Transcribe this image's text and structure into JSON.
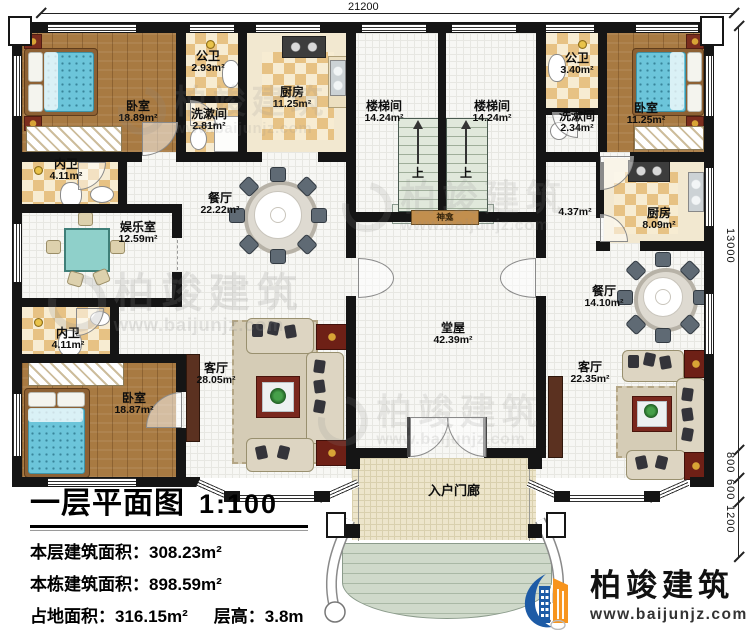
{
  "dimensions": {
    "top_width": "21200",
    "right_height": "13000",
    "right_seg_800": "800",
    "right_seg_600": "600",
    "right_seg_1200": "1200"
  },
  "rooms": {
    "bedroom_tl": {
      "name": "卧室",
      "area": "18.89m²"
    },
    "bath_tl": {
      "name": "公卫",
      "area": "2.93m²"
    },
    "wash_tl": {
      "name": "洗漱间",
      "area": "2.81m²"
    },
    "kitchen_l": {
      "name": "厨房",
      "area": "11.25m²"
    },
    "stair_l": {
      "name": "楼梯间",
      "area": "14.24m²"
    },
    "stair_r": {
      "name": "楼梯间",
      "area": "14.24m²"
    },
    "bath_tr": {
      "name": "公卫",
      "area": "3.40m²"
    },
    "wash_tr": {
      "name": "洗漱间",
      "area": "2.34m²"
    },
    "bedroom_tr": {
      "name": "卧室",
      "area": "11.25m²"
    },
    "ensuite_tl": {
      "name": "内卫",
      "area": "4.11m²"
    },
    "entertainment": {
      "name": "娱乐室",
      "area": "12.59m²"
    },
    "dining_l": {
      "name": "餐厅",
      "area": "22.22m²"
    },
    "corridor_r": {
      "area": "4.37m²"
    },
    "kitchen_r": {
      "name": "厨房",
      "area": "8.09m²"
    },
    "dining_r": {
      "name": "餐厅",
      "area": "14.10m²"
    },
    "ensuite_bl": {
      "name": "内卫",
      "area": "4.11m²"
    },
    "bedroom_bl": {
      "name": "卧室",
      "area": "18.87m²"
    },
    "living_l": {
      "name": "客厅",
      "area": "28.05m²"
    },
    "hall": {
      "name": "堂屋",
      "area": "42.39m²"
    },
    "living_r": {
      "name": "客厅",
      "area": "22.35m²"
    },
    "porch": {
      "name": "入户门廊"
    }
  },
  "features": {
    "shrine": "神龛",
    "stairs_up": "上"
  },
  "info": {
    "title": "一层平面图",
    "scale": "1:100",
    "floor_area_label": "本层建筑面积：",
    "floor_area_value": "308.23m²",
    "building_area_label": "本栋建筑面积：",
    "building_area_value": "898.59m²",
    "footprint_label": "占地面积：",
    "footprint_value": "316.15m²",
    "height_label": "层高：",
    "height_value": "3.8m"
  },
  "brand": {
    "name": "柏竣建筑",
    "url": "www.baijunjz.com"
  },
  "watermark": {
    "name": "柏竣建筑",
    "url": "www.baijunjz.com"
  },
  "colors": {
    "wall": "#151515",
    "accent_blue": "#1d5ba6",
    "accent_orange": "#f7941d",
    "checker": "#e7c284",
    "wood": "#a87a42"
  }
}
